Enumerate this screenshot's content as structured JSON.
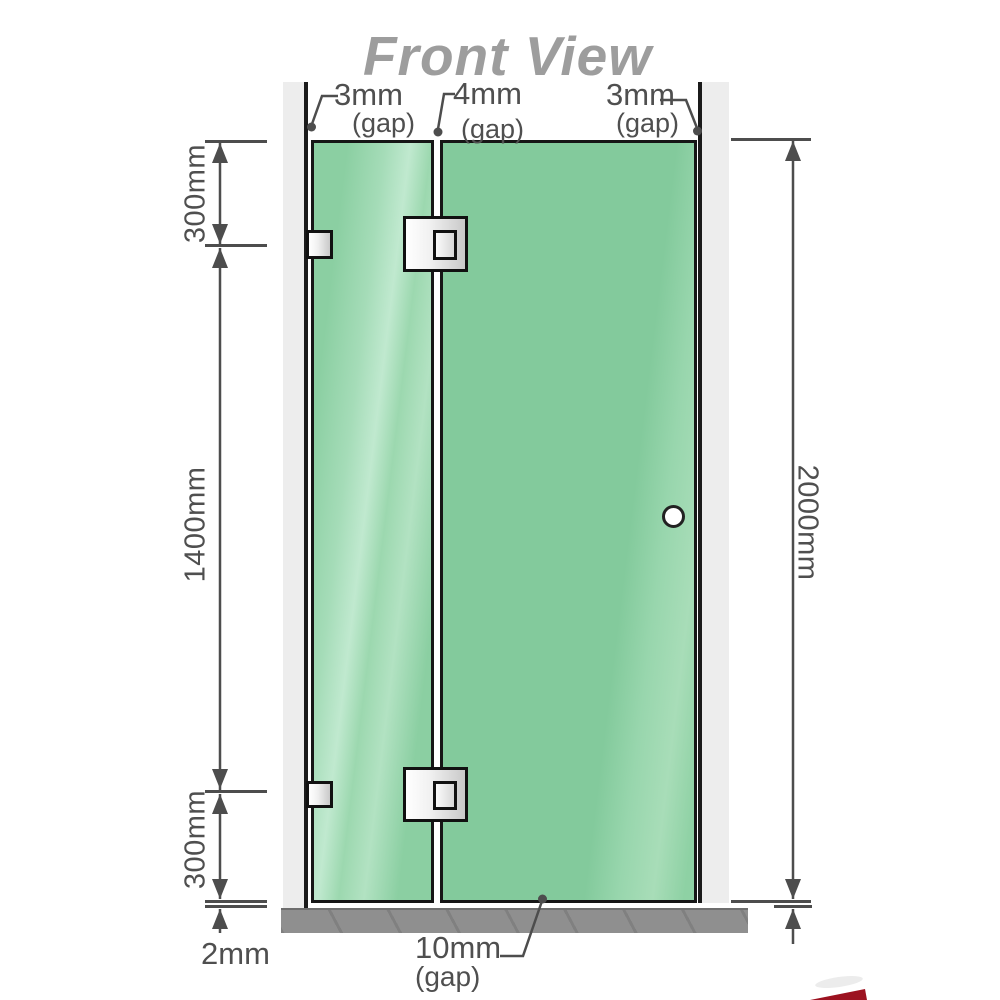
{
  "title": "Front View",
  "annotations": {
    "gap_top_left": {
      "value": "3mm",
      "label": "(gap)"
    },
    "gap_top_middle": {
      "value": "4mm",
      "label": "(gap)"
    },
    "gap_top_right": {
      "value": "3mm",
      "label": "(gap)"
    },
    "gap_bottom": {
      "value": "10mm",
      "label": "(gap)"
    },
    "base_thickness": "2mm"
  },
  "dimensions": {
    "left_top": "300mm",
    "left_middle": "1400mm",
    "left_bottom": "300mm",
    "right_full": "2000mm"
  },
  "colors": {
    "glass_green": "#85cb9e",
    "glass_highlight": "#b7e4c7",
    "wall_gray": "#ededed",
    "floor_gray": "#8f8f8f",
    "line_gray": "#4d4d4d",
    "title_gray": "#9d9d9d",
    "hardware_silver": "#e8e8e8",
    "logo_red": "#9c1220"
  }
}
